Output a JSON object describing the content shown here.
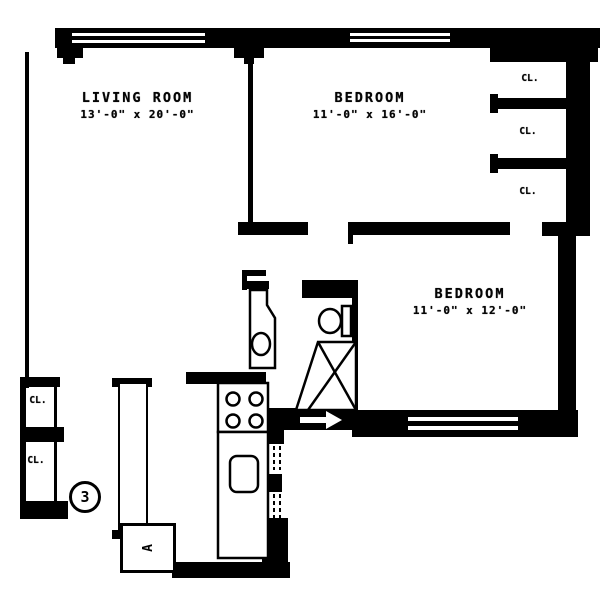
{
  "unit": {
    "number": "3"
  },
  "rooms": {
    "living_room": {
      "name": "LIVING ROOM",
      "dims": "13'-0\" x 20'-0\""
    },
    "bedroom_1": {
      "name": "BEDROOM",
      "dims": "11'-0\" x 16'-0\""
    },
    "bedroom_2": {
      "name": "BEDROOM",
      "dims": "11'-0\" x 12'-0\""
    }
  },
  "labels": {
    "closet": "CL.",
    "appliance": "A"
  },
  "colors": {
    "ink": "#000000",
    "paper": "#ffffff"
  }
}
